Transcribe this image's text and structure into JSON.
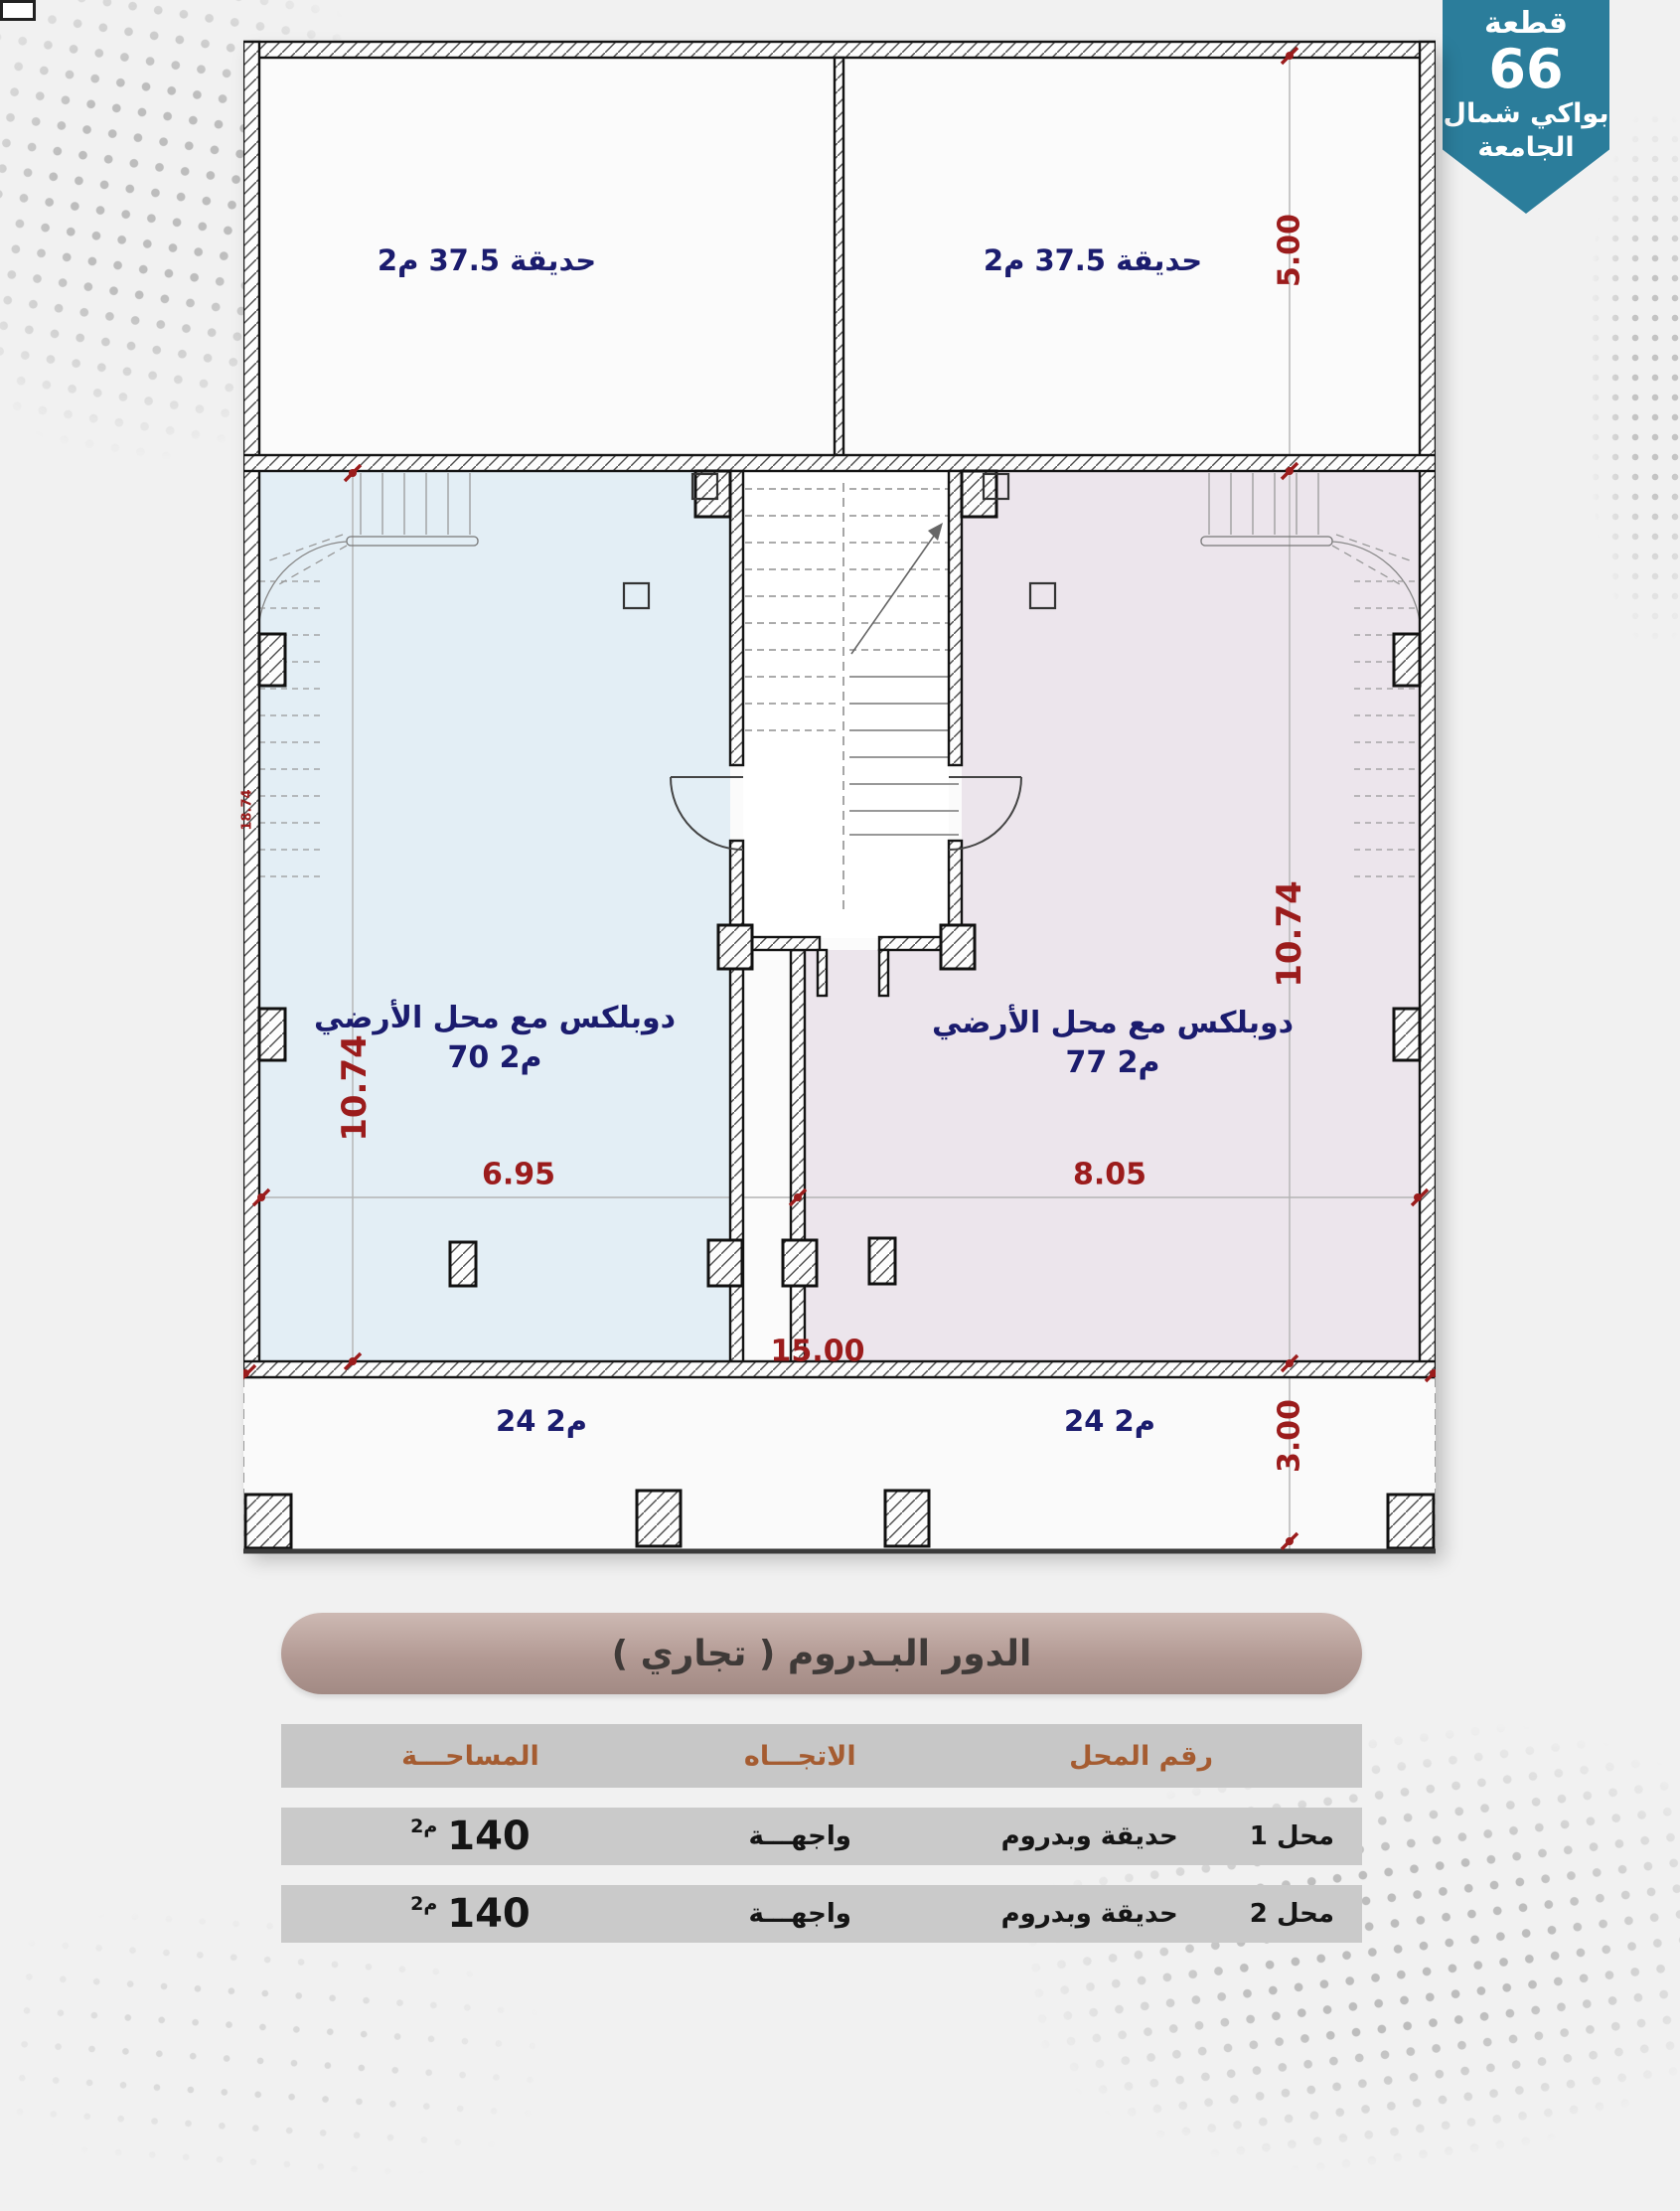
{
  "badge": {
    "line1": "قطعة",
    "number": "66",
    "line2": "بواكي شمال",
    "line3": "الجامعة",
    "bg_color": "#2b7d9b"
  },
  "plan": {
    "gardens": {
      "left_label": "حديقة 37.5 م2",
      "right_label": "حديقة 37.5 م2"
    },
    "units": {
      "left": {
        "line1": "دوبلكس مع  محل الأرضي",
        "line2": "70 م2"
      },
      "right": {
        "line1": "دوبلكس مع  محل الأرضي",
        "line2": "77 م2"
      }
    },
    "arcade": {
      "left_label": "24 م2",
      "right_label": "24 م2"
    },
    "dimensions": {
      "garden_height": "5.00",
      "unit_height_left": "10.74",
      "unit_height_right": "10.74",
      "total_height": "18.74",
      "arcade_height": "3.00",
      "unit_width_left": "6.95",
      "unit_width_right": "8.05",
      "total_width": "15.00"
    },
    "colors": {
      "unit_left_fill": "#e3eef5",
      "unit_right_fill": "#ece5ec",
      "dim_color": "#9b1c1c",
      "label_color": "#1b1c6e"
    }
  },
  "title_bar": {
    "text": "الدور البـدروم ( تجاري )"
  },
  "table": {
    "headers": {
      "shop": "رقم المحل",
      "direction": "الاتجـــاه",
      "area": "المساحـــة"
    },
    "rows": [
      {
        "shop": "محل 1",
        "desc": "حديقة وبدروم",
        "direction": "واجهـــة",
        "area_value": "140",
        "area_unit": "م2"
      },
      {
        "shop": "محل 2",
        "desc": "حديقة وبدروم",
        "direction": "واجهـــة",
        "area_value": "140",
        "area_unit": "م2"
      }
    ]
  }
}
